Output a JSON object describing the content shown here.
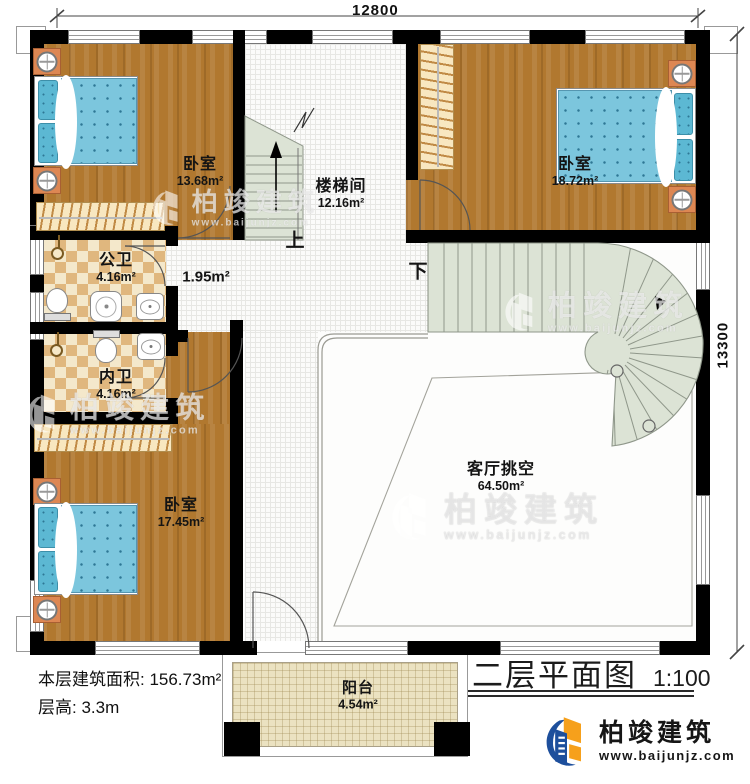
{
  "title_block": {
    "title": "二层平面图",
    "scale": "1:100"
  },
  "dimensions": {
    "top": "12800",
    "right": "13300"
  },
  "rooms": {
    "bedroom_tl": {
      "name": "卧室",
      "area": "13.68m²"
    },
    "stairwell": {
      "name": "楼梯间",
      "area": "12.16m²"
    },
    "bedroom_tr": {
      "name": "卧室",
      "area": "18.72m²"
    },
    "bath_public": {
      "name": "公卫",
      "area": "4.16m²"
    },
    "bath_private": {
      "name": "内卫",
      "area": "4.16m²"
    },
    "bedroom_bl": {
      "name": "卧室",
      "area": "17.45m²"
    },
    "living_void": {
      "name": "客厅挑空",
      "area": "64.50m²"
    },
    "balcony": {
      "name": "阳台",
      "area": "4.54m²"
    },
    "hall": {
      "area": "1.95m²"
    }
  },
  "stair_labels": {
    "up": "上",
    "down": "下"
  },
  "notes": {
    "floor_area": "本层建筑面积: 156.73m²",
    "floor_height": "层高: 3.3m"
  },
  "brand": {
    "name": "柏竣建筑",
    "website": "www.baijunjz.com"
  },
  "watermark": {
    "name": "柏竣建筑",
    "website": "www.baijunjz.com"
  },
  "colors": {
    "wall": "#000000",
    "wood": "#b1782f",
    "bed_blue": "#7cc6dd",
    "tile_dark": "#e0b77e",
    "tile_light": "#f4e8cb",
    "stair_green": "#dce3d5",
    "balcony_floor": "#ebe2c1",
    "brand_blue": "#1d4f9c",
    "brand_orange": "#f6a01b"
  }
}
